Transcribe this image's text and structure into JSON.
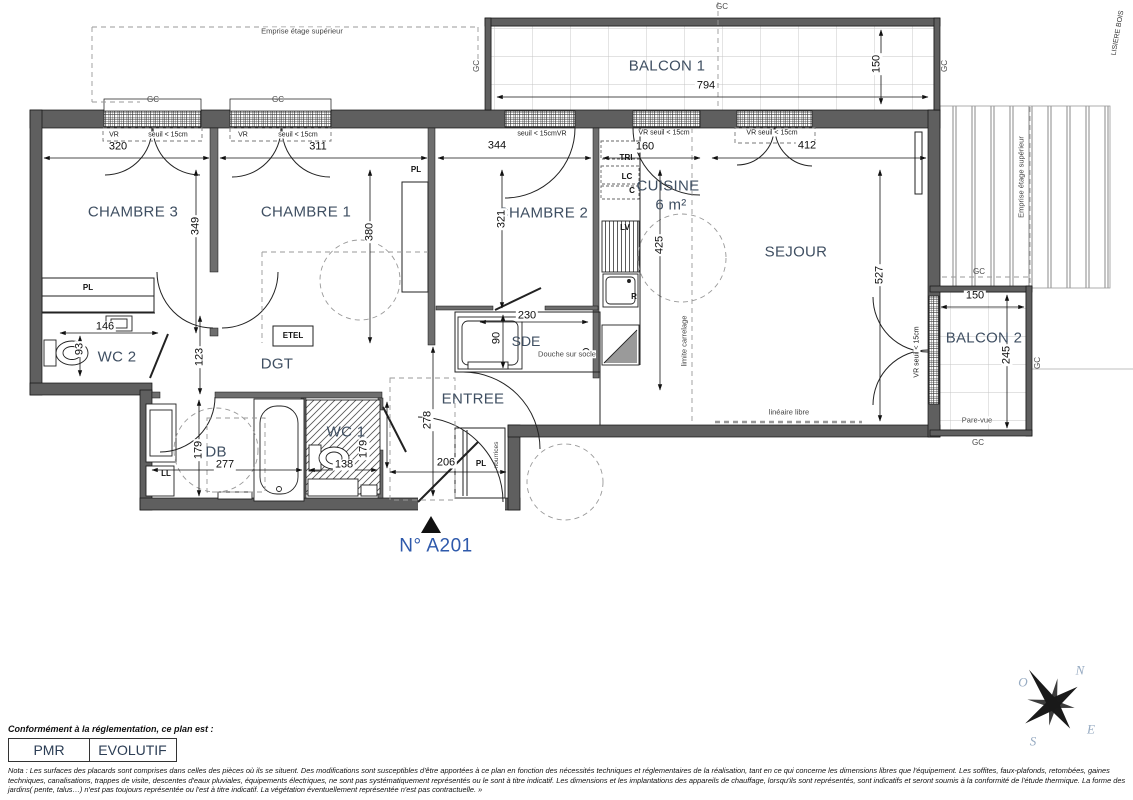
{
  "plan": {
    "unit": "N° A201"
  },
  "rooms": {
    "chambre3": "CHAMBRE 3",
    "chambre1": "CHAMBRE 1",
    "chambre2": "CHAMBRE 2",
    "cuisine": "CUISINE",
    "cuisine_surface": "6 m²",
    "sejour": "SEJOUR",
    "balcon1": "BALCON 1",
    "balcon2": "BALCON 2",
    "wc2": "WC 2",
    "dgt": "DGT",
    "sdb": "SDB",
    "wc1": "WC 1",
    "sde": "SDE",
    "entree": "ENTREE"
  },
  "dims": {
    "balcon1_w": "794",
    "balcon1_d": "150",
    "chambre3_w": "320",
    "chambre3_h": "349",
    "chambre1_w": "311",
    "chambre1_h": "380",
    "chambre2_w": "344",
    "chambre2_h": "321",
    "cuisine_w": "160",
    "cuisine_h": "425",
    "sejour_w": "412",
    "sejour_h": "527",
    "balcon2_w": "150",
    "balcon2_d": "245",
    "wc2_w": "146",
    "wc2_h": "93",
    "dgt_h": "123",
    "sdb_w": "277",
    "sdb_h": "179",
    "wc1_w": "138",
    "wc1_h": "179",
    "sde_w": "230",
    "sde_h": "90",
    "entree_w": "206",
    "entree_h": "278"
  },
  "labels": {
    "gc": "GC",
    "emprise": "Emprise étage supérieur",
    "lisiere": "LISIERE BOIS",
    "vr": "VR",
    "seuil": "seuil < 15cm",
    "seuil_vr": "seuil < 15cmVR",
    "vr_seuil": "VR seuil < 15cm",
    "pl": "PL",
    "etel": "ETEL",
    "ll": "LL",
    "tri": "TRI",
    "lc": "LC",
    "c": "C",
    "lv": "LV",
    "r": "R",
    "limite_carrelage": "limite carrelage",
    "lineaire_libre": "linéaire libre",
    "pare_vue": "Pare-vue",
    "douche": "Douche sur socle",
    "nourrices": "nourrices"
  },
  "legend": {
    "caption": "Conformément à la réglementation, ce plan est :",
    "pmr": "PMR",
    "evolutif": "EVOLUTIF"
  },
  "nota": "Nota : Les surfaces des placards sont comprises dans celles des pièces où ils se situent. Des modifications sont susceptibles d'être apportées à ce plan en fonction des nécessités techniques et réglementaires de la réalisation, tant en ce qui concerne les dimensions libres que l'équipement.  Les soffites, faux-plafonds, retombées, gaines techniques, canalisations, trappes de visite, descentes d'eaux pluviales, équipements électriques, ne sont pas systématiquement représentés ou le sont à titre indicatif. Les dimensions et les implantations des appareils de chauffage, lorsqu'ils sont représentés, sont indicatifs et seront soumis à la conformité de l'étude thermique. La forme des jardins( pente, talus…) n'est pas toujours représentée ou l'est à titre indicatif. La végétation éventuellement représentée n'est pas contractuelle. »",
  "compass": {
    "n": "N",
    "o": "O",
    "e": "E",
    "s": "S"
  },
  "colors": {
    "unit_blue": "#2e59ab",
    "room_label": "#3f4f62",
    "wall_grey": "#5f5f5f"
  }
}
